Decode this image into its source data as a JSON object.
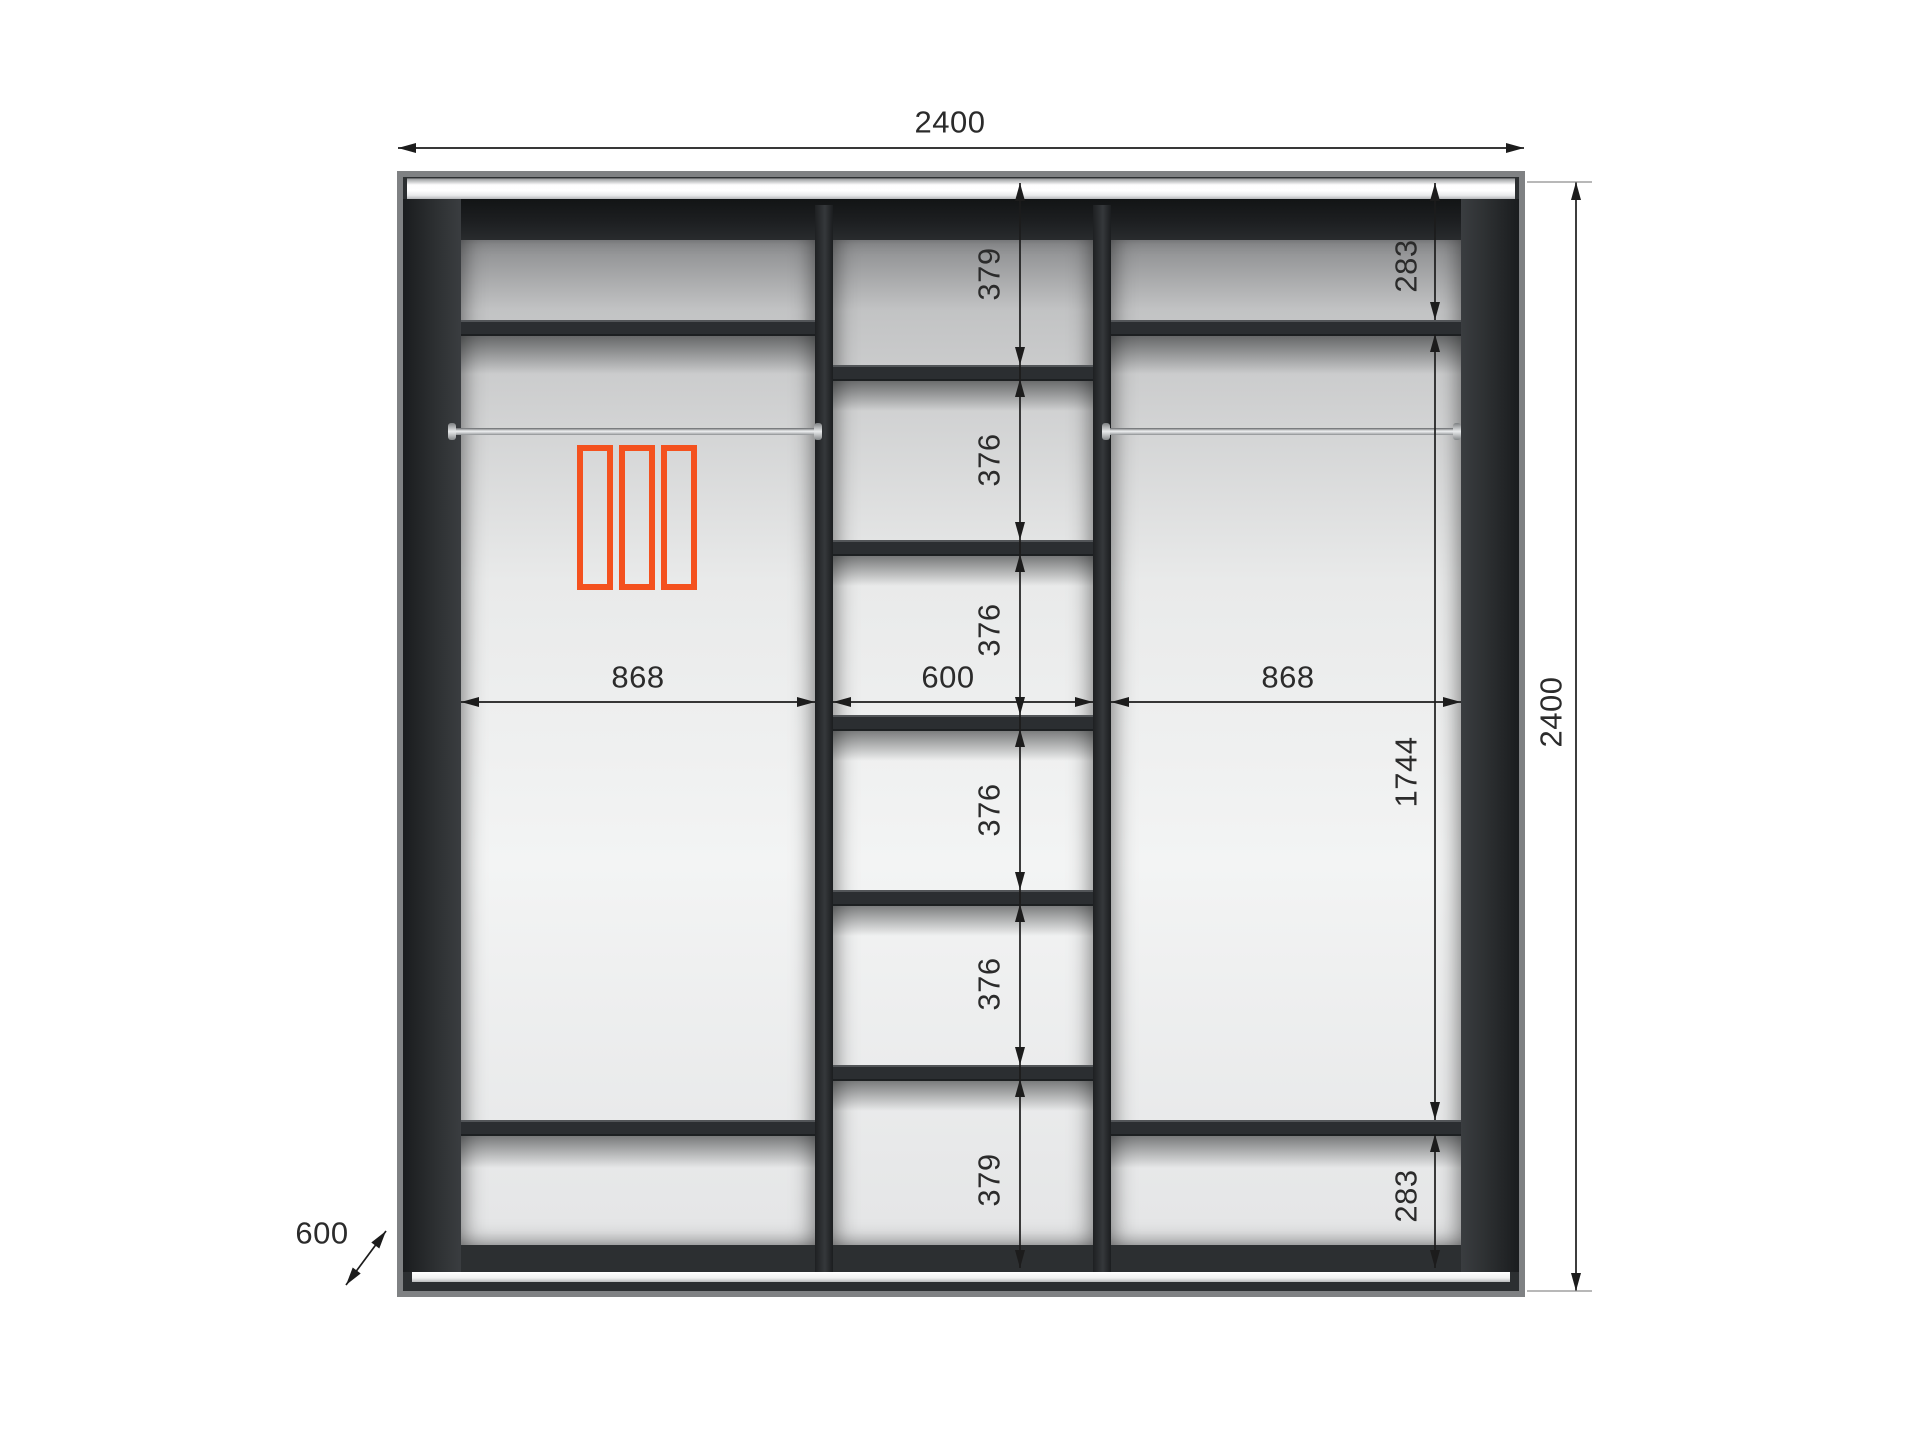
{
  "diagram": {
    "dimensions": {
      "overall_width": "2400",
      "overall_height": "2400",
      "depth": "600",
      "left_section_width": "868",
      "middle_section_width": "600",
      "right_section_width": "868",
      "middle_shelf_gaps": [
        "379",
        "376",
        "376",
        "376",
        "376",
        "379"
      ],
      "right_section": {
        "top_gap": "283",
        "hanging_gap": "1744",
        "bottom_gap": "283"
      }
    },
    "colors": {
      "accent_orange": "#f4511e",
      "frame_dark": "#2c2f31",
      "frame_edge": "#7f8183",
      "dimension_ink": "#1c1c1c"
    }
  }
}
